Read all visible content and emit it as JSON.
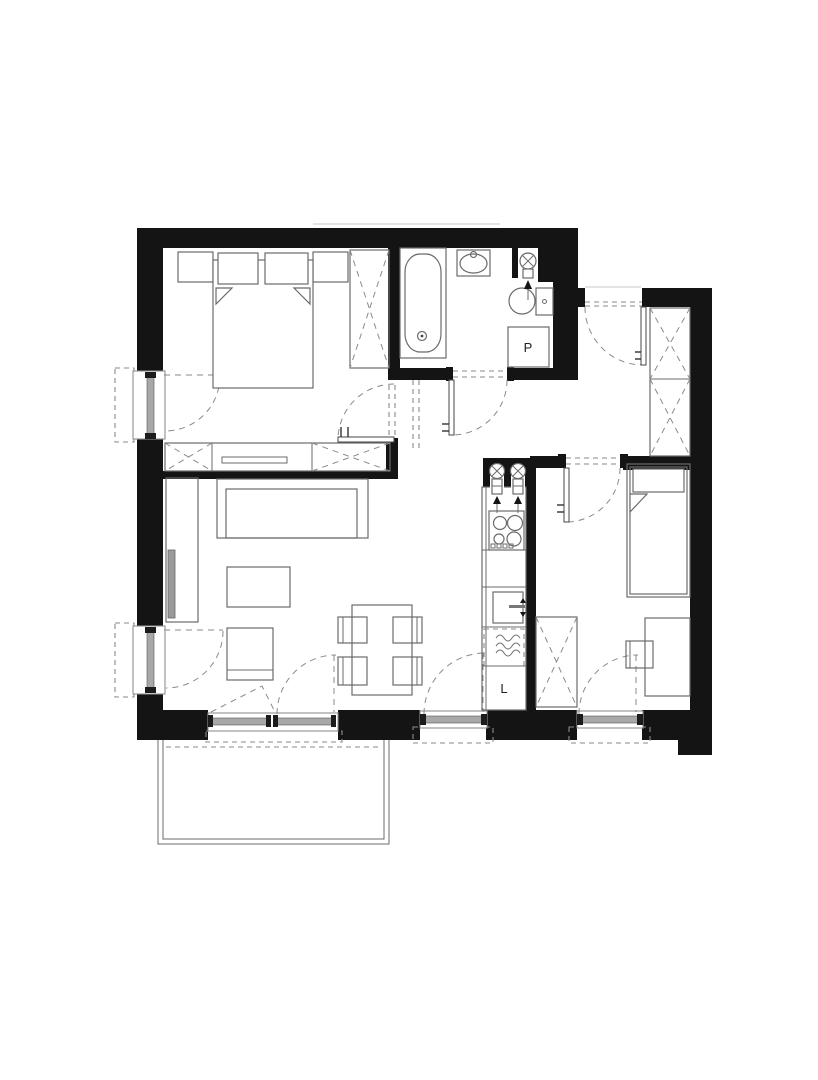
{
  "plan": {
    "kind": "apartment-floor-plan",
    "labels": {
      "washing_machine": "P",
      "fridge": "L"
    },
    "colors": {
      "background": "#ffffff",
      "wall": "#141414",
      "furniture_line": "#6b6b6b",
      "dashed_line": "#8a8a8a",
      "frame_line": "#8f8f8f"
    },
    "fixtures": [
      "double-bed",
      "nightstands",
      "tall-wardrobe",
      "built-in-wardrobe-row",
      "bathtub",
      "washbasin",
      "toilet",
      "washing-machine-box",
      "water-valves",
      "kitchenette-strip",
      "cooktop-4-burner",
      "kitchen-sink",
      "dishwasher-waves",
      "fridge-box",
      "sofa",
      "coffee-table",
      "armchair",
      "tv-cabinet",
      "dining-table-4-chairs",
      "single-bed",
      "desk",
      "desk-chair",
      "hall-wardrobe",
      "balcony"
    ]
  }
}
